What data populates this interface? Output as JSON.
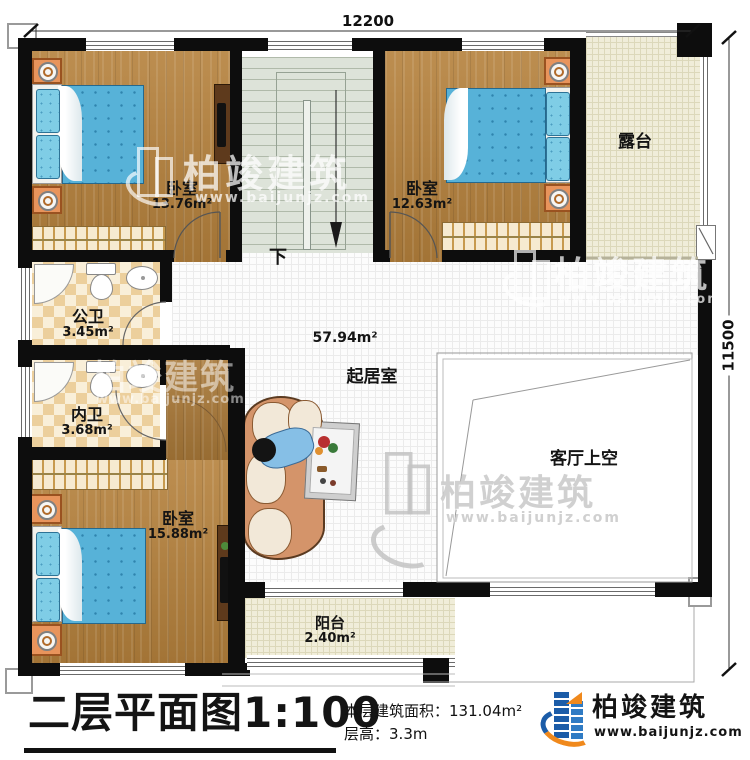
{
  "plan": {
    "dimensions": {
      "width_mm": "12200",
      "height_mm": "11500"
    },
    "rooms": {
      "bedroom_tl": {
        "label": "卧室",
        "area": "13.76m²"
      },
      "bedroom_tr": {
        "label": "卧室",
        "area": "12.63m²"
      },
      "terrace": {
        "label": "露台"
      },
      "public_bath": {
        "label": "公卫",
        "area": "3.45m²"
      },
      "private_bath": {
        "label": "内卫",
        "area": "3.68m²"
      },
      "bedroom_bl": {
        "label": "卧室",
        "area": "15.88m²"
      },
      "living": {
        "label": "起居室",
        "area": "57.94m²"
      },
      "void": {
        "label": "客厅上空"
      },
      "balcony": {
        "label": "阳台",
        "area": "2.40m²"
      }
    },
    "stairs": {
      "direction_label": "下"
    }
  },
  "title_block": {
    "title": "二层平面图1:100",
    "area_label": "本层建筑面积：",
    "area_value": "131.04m²",
    "height_label": "层高：",
    "height_value": "3.3m"
  },
  "brand": {
    "name": "柏竣建筑",
    "website": "www.baijunjz.com"
  },
  "watermark": {
    "name": "柏竣建筑",
    "website": "www.baijunjz.com"
  },
  "colors": {
    "wall": "#0d0d0d",
    "wood_floor": "#b5813c",
    "terrace_tile": "#f0edd9",
    "bathroom_tile": "#eccf9c",
    "stair_floor": "#dde3d9",
    "bed_blanket": "#57b2d8",
    "sofa": "#d4946a",
    "nightstand": "#e8945c",
    "brand_blue": "#1b5ca8",
    "brand_orange": "#f0891c"
  }
}
